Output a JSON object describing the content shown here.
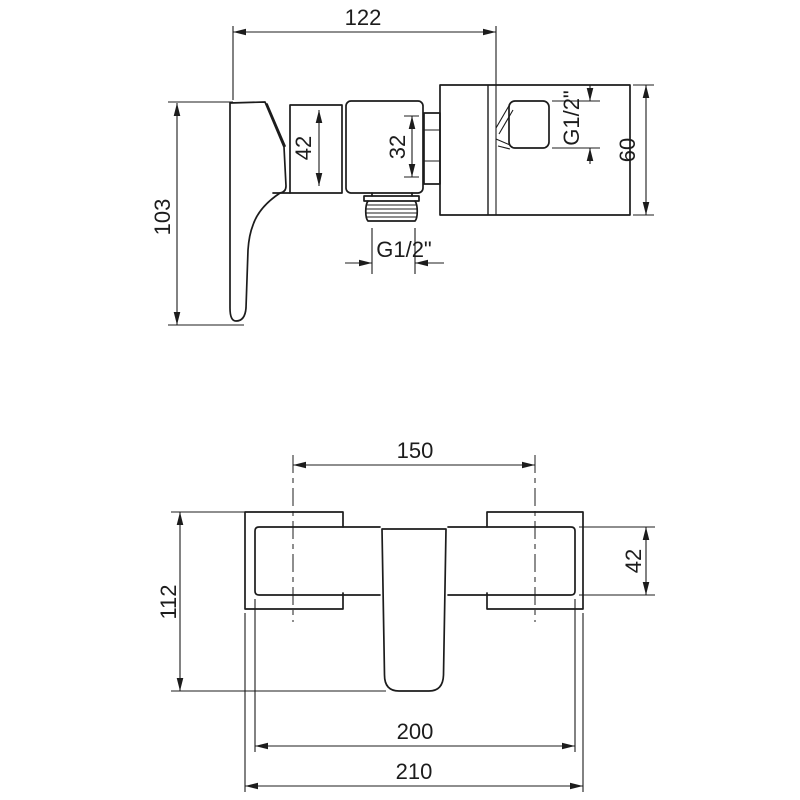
{
  "drawing": {
    "title": "shower-mixer-dimension-drawing",
    "colors": {
      "line": "#1c1c1c",
      "background": "#ffffff"
    },
    "side_view": {
      "overall_width": "122",
      "overall_height": "103",
      "cartridge_height": "42",
      "connection_size": "32",
      "wall_outlet_thread": "G1/2\"",
      "wall_plate_height": "60",
      "bottom_outlet_thread": "G1/2\""
    },
    "front_view": {
      "mount_centers_distance": "150",
      "overall_height": "112",
      "body_height": "42",
      "body_width": "200",
      "overall_width": "210"
    }
  }
}
